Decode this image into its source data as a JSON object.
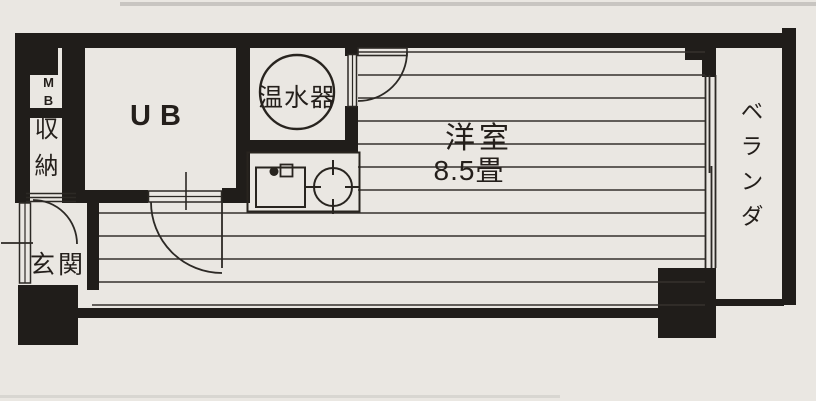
{
  "plan": {
    "type": "apartment-floor-plan",
    "colors": {
      "paper": "#eae7e2",
      "ink": "#201d1a",
      "line": "#35312d"
    },
    "rooms": {
      "meter_box": {
        "label": "MB"
      },
      "storage": {
        "label": "収納"
      },
      "entrance": {
        "label": "玄関"
      },
      "unit_bath": {
        "label": "UB"
      },
      "water_heater": {
        "label": "温水器"
      },
      "main_room": {
        "label": "洋室",
        "size": "8.5畳"
      },
      "veranda": {
        "label": "ベランダ"
      }
    }
  }
}
